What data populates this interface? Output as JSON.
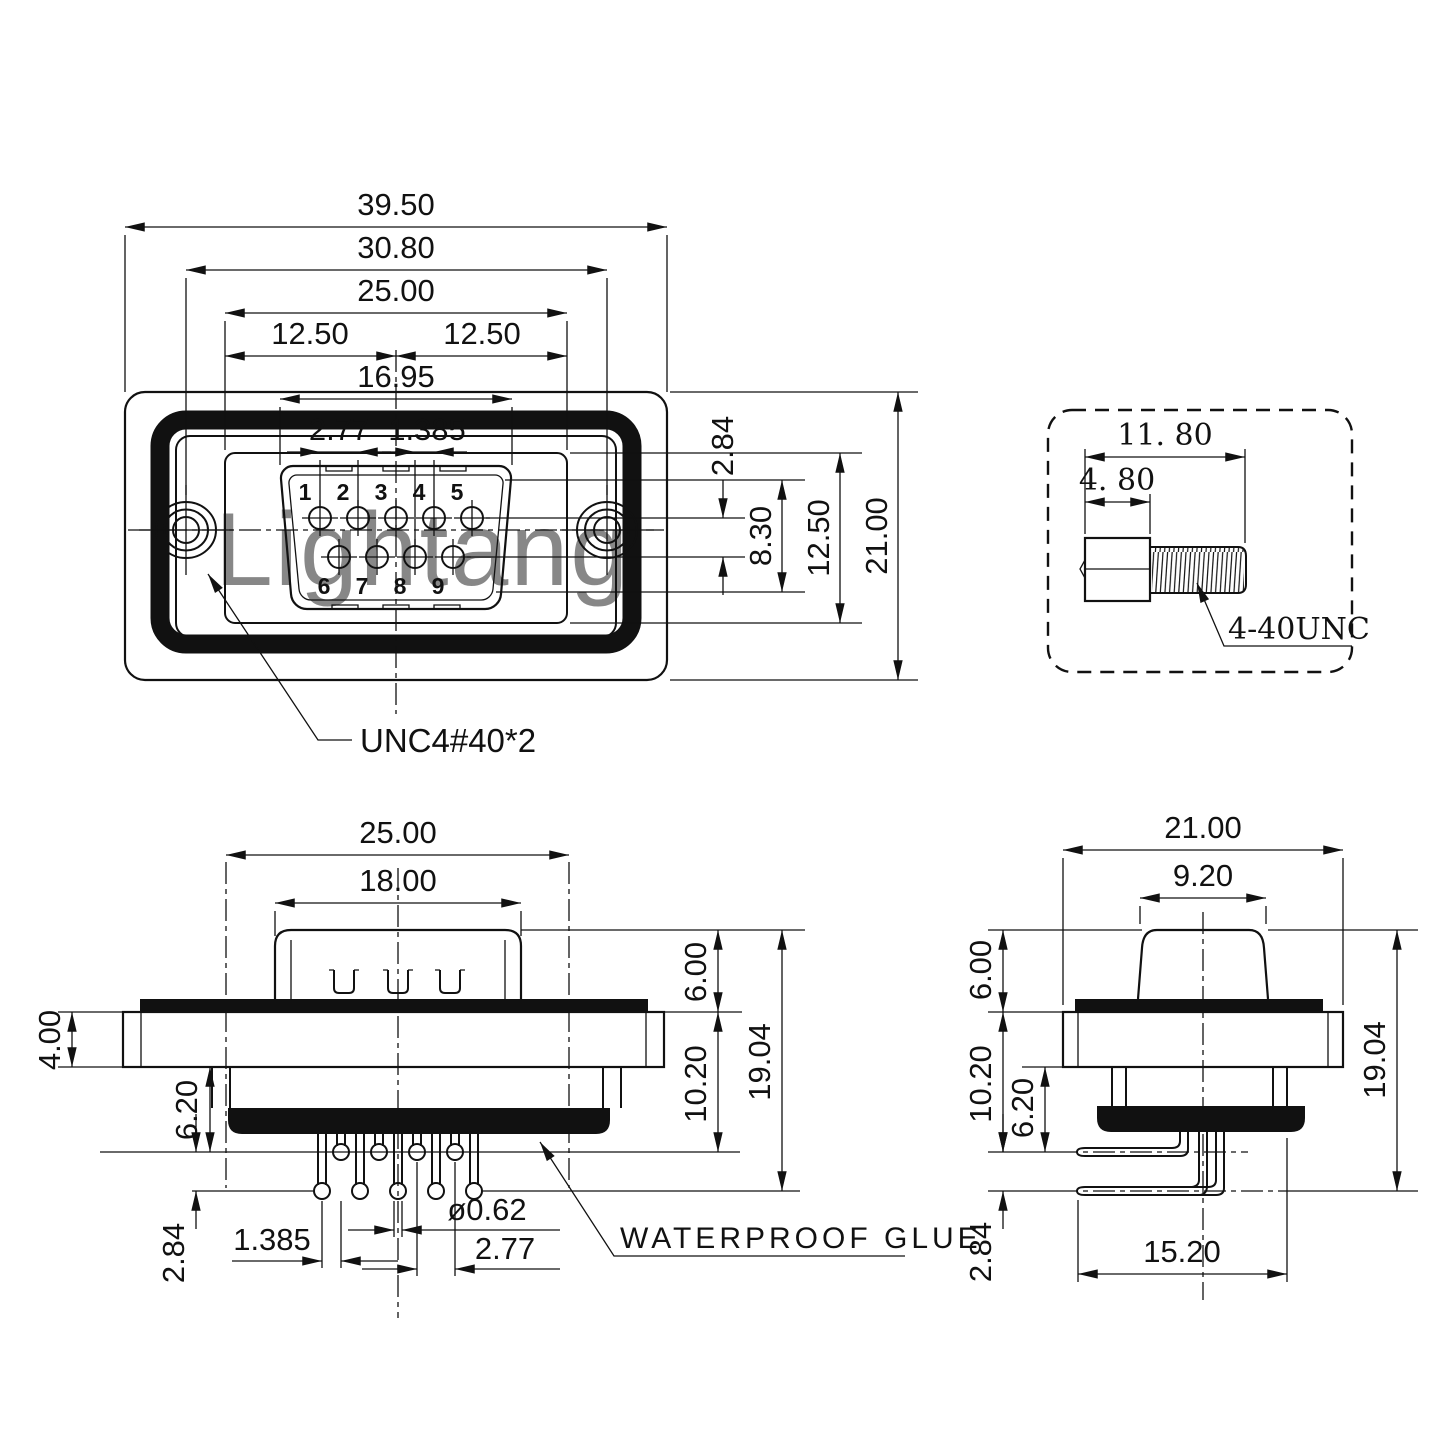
{
  "watermark": "Lightang",
  "watermark_color": "#e7adad",
  "front_view": {
    "dims": {
      "overall_width": "39.50",
      "hole_spacing": "30.80",
      "insert_width": "25.00",
      "half_left": "12.50",
      "half_right": "12.50",
      "shell_width": "16.95",
      "pin_pitch": "2.77",
      "pin_half_pitch": "1.385",
      "row_offset": "2.84",
      "shell_height": "8.30",
      "insert_height": "12.50",
      "body_height": "21.00"
    },
    "pins": [
      "1",
      "2",
      "3",
      "4",
      "5",
      "6",
      "7",
      "8",
      "9"
    ],
    "thread_note": "UNC4#40*2"
  },
  "screw_view": {
    "dims": {
      "total_length": "11. 80",
      "head_length": "4. 80"
    },
    "thread_spec": "4-40UNC"
  },
  "side_view": {
    "dims": {
      "insert_width": "25.00",
      "shell_width": "18.00",
      "flange_thickness": "4.00",
      "glue_depth": "6.20",
      "row_offset": "2.84",
      "pin_half_pitch": "1.385",
      "pin_diameter": "ø0.62",
      "pin_pitch": "2.77",
      "shell_height": "6.00",
      "body_depth": "10.20",
      "total_height": "19.04"
    },
    "glue_label": "WATERPROOF GLUE"
  },
  "end_view": {
    "dims": {
      "body_width": "21.00",
      "shell_width": "9.20",
      "shell_height": "6.00",
      "body_depth": "10.20",
      "glue_depth": "6.20",
      "row_offset": "2.84",
      "total_height": "19.04",
      "pin_span": "15.20"
    }
  }
}
